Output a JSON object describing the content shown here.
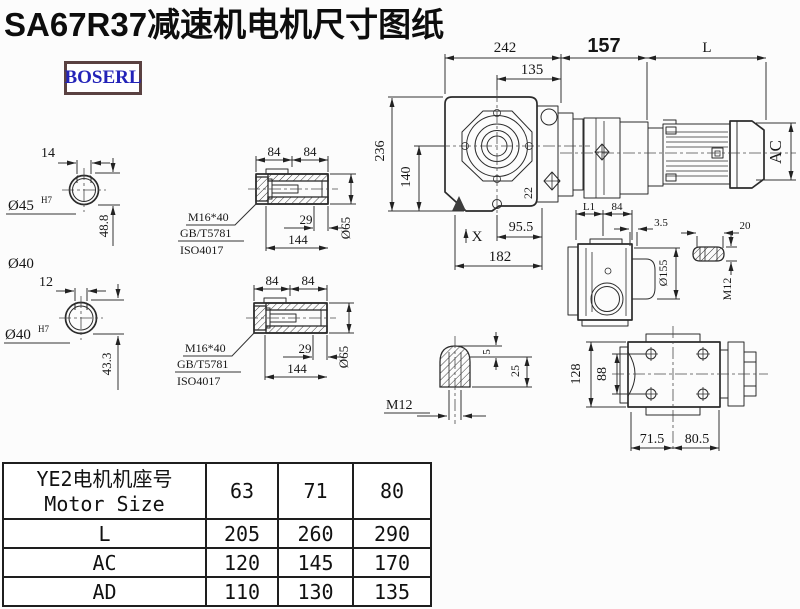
{
  "title": "SA67R37减速机电机尺寸图纸",
  "logo": {
    "text": "BOSERL"
  },
  "colors": {
    "line": "#2b2b2b",
    "dim_text": "#161616",
    "logo_text": "#2323b8",
    "logo_border": "#5a4141",
    "table_border": "#1e1e1e",
    "background": "#fcfcfc"
  },
  "views": {
    "keyway45": {
      "w": "14",
      "bore": "Ø45",
      "tol": "H7",
      "h": "48.8",
      "od": "Ø40"
    },
    "keyway40": {
      "w": "12",
      "bore": "Ø40",
      "tol": "H7",
      "h": "43.3"
    },
    "shaftA": {
      "s1": "84",
      "s2": "84",
      "bolt": "M16*40",
      "gb": "GB/T5781",
      "iso": "ISO4017",
      "d29": "29",
      "d144": "144",
      "dia": "Ø65"
    },
    "shaftB": {
      "s1": "84",
      "s2": "84",
      "bolt": "M16*40",
      "gb": "GB/T5781",
      "iso": "ISO4017",
      "d29": "29",
      "d144": "144",
      "dia": "Ø65"
    },
    "front": {
      "w": "242",
      "f": "135",
      "h": "236",
      "ch": "140",
      "a": "22",
      "b1": "95.5",
      "b2": "182",
      "x": "X"
    },
    "motor": {
      "adapter": "157",
      "len": "L",
      "dia": "AC"
    },
    "side": {
      "l1": "L1",
      "s84": "84",
      "g": "3.5",
      "dia": "Ø155",
      "d20": "20",
      "plug": "M12"
    },
    "plug": {
      "m": "M12",
      "d5": "5",
      "d25": "25"
    },
    "bottom": {
      "h1": "128",
      "h2": "88",
      "w1": "71.5",
      "w2": "80.5"
    }
  },
  "table": {
    "header": {
      "row_label_cn": "YE2电机机座号",
      "row_label_en": "Motor Size",
      "cols": [
        "63",
        "71",
        "80"
      ]
    },
    "rows": [
      {
        "label": "L",
        "values": [
          "205",
          "260",
          "290"
        ]
      },
      {
        "label": "AC",
        "values": [
          "120",
          "145",
          "170"
        ]
      },
      {
        "label": "AD",
        "values": [
          "110",
          "130",
          "135"
        ]
      }
    ]
  }
}
